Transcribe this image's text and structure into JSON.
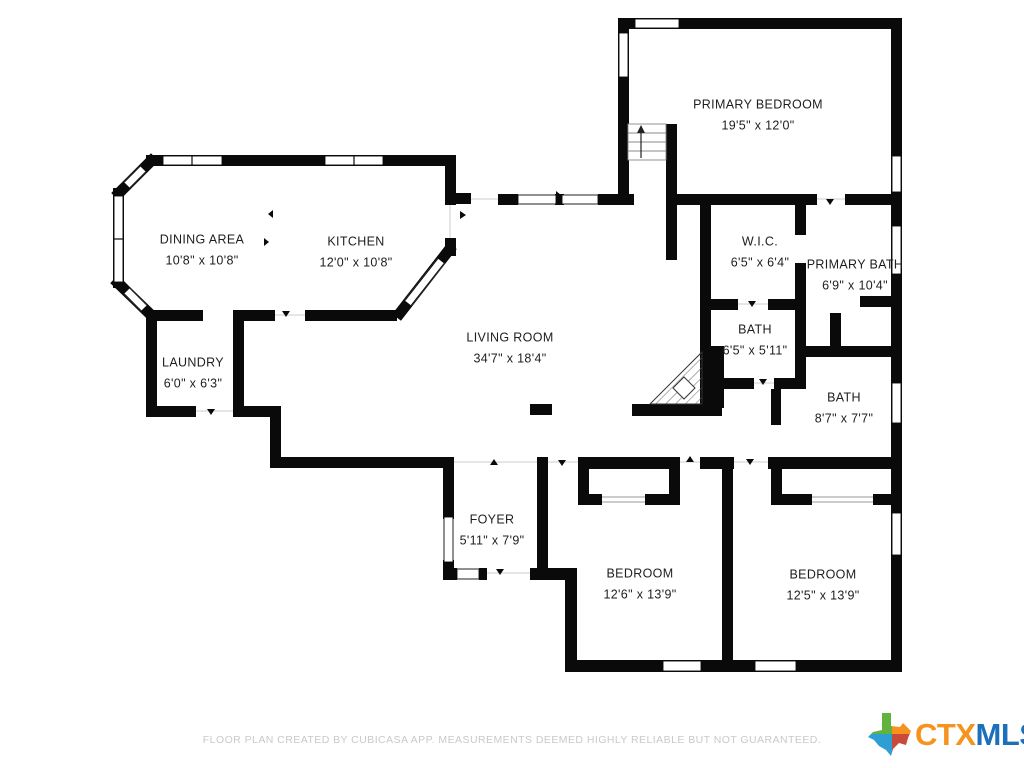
{
  "rooms": [
    {
      "id": "primary-bedroom",
      "name": "PRIMARY BEDROOM",
      "dims": "19'5\" x 12'0\""
    },
    {
      "id": "dining-area",
      "name": "DINING AREA",
      "dims": "10'8\" x 10'8\""
    },
    {
      "id": "kitchen",
      "name": "KITCHEN",
      "dims": "12'0\" x 10'8\""
    },
    {
      "id": "living-room",
      "name": "LIVING ROOM",
      "dims": "34'7\" x 18'4\""
    },
    {
      "id": "laundry",
      "name": "LAUNDRY",
      "dims": "6'0\" x 6'3\""
    },
    {
      "id": "wic",
      "name": "W.I.C.",
      "dims": "6'5\" x 6'4\""
    },
    {
      "id": "primary-bath",
      "name": "PRIMARY BATH",
      "dims": "6'9\" x 10'4\""
    },
    {
      "id": "bath-hall",
      "name": "BATH",
      "dims": "6'5\" x 5'11\""
    },
    {
      "id": "bath-2",
      "name": "BATH",
      "dims": "8'7\" x 7'7\""
    },
    {
      "id": "foyer",
      "name": "FOYER",
      "dims": "5'11\" x 7'9\""
    },
    {
      "id": "bedroom-1",
      "name": "BEDROOM",
      "dims": "12'6\" x 13'9\""
    },
    {
      "id": "bedroom-2",
      "name": "BEDROOM",
      "dims": "12'5\" x 13'9\""
    }
  ],
  "footer": {
    "disclaimer": "FLOOR PLAN CREATED BY CUBICASA APP. MEASUREMENTS DEEMED HIGHLY RELIABLE BUT NOT GUARANTEED."
  },
  "logo": {
    "ctx": "CTX",
    "mls": "MLS",
    "ctx_color": "#f6921e",
    "mls_color": "#1c6fba",
    "texas_colors": [
      "#62b33e",
      "#f6921e",
      "#2e9fd4",
      "#c9493b"
    ]
  },
  "colors": {
    "wall": "#0a0a0a",
    "background": "#ffffff",
    "label_text": "#1e1e1e",
    "disclaimer_text": "#c9c9c9"
  }
}
